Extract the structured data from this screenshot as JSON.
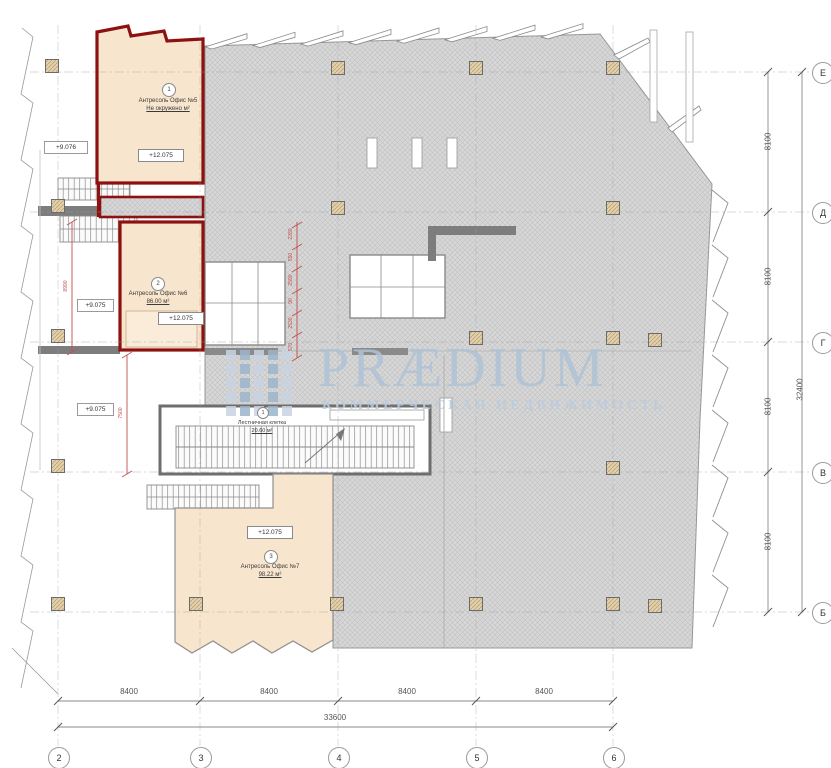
{
  "watermark": {
    "brand": "PRÆDIUM",
    "tagline": "КОММЕРЧЕСКАЯ НЕДВИЖИМОСТЬ"
  },
  "rooms": [
    {
      "num": "1",
      "name": "Антресоль Офис №5",
      "area": "Не окружено м²",
      "level": "+12.075"
    },
    {
      "num": "2",
      "name": "Антресоль Офис №6",
      "area": "86.00 м²",
      "level": "+12.075"
    },
    {
      "num": "3",
      "name": "Антресоль Офис №7",
      "area": "98.22 м²",
      "level": "+12.075"
    }
  ],
  "stairwell": {
    "num": "1",
    "name": "Лестничная клетка",
    "area": "20.60 м²"
  },
  "elevation_marks": {
    "left_upper": "+9.076",
    "left_middle": "+9.075",
    "left_lower": "+9.075"
  },
  "axes": {
    "bottom": [
      "2",
      "3",
      "4",
      "5",
      "6"
    ],
    "right": [
      "Е",
      "Д",
      "Г",
      "В",
      "Б"
    ]
  },
  "dimensions": {
    "bottom_segments": [
      "8400",
      "8400",
      "8400",
      "8400"
    ],
    "bottom_total": "33600",
    "right_segments": [
      "8100",
      "8100",
      "8100",
      "8100"
    ],
    "right_total": "32400",
    "red_chain": [
      "2280",
      "550",
      "2590",
      "90",
      "2530",
      "570"
    ],
    "red_left_height": "8990",
    "red_mid_height": "7500"
  },
  "colors": {
    "room_fill": "#f8e5cd",
    "room_outline": "#8e1111",
    "slab_gray": "#d7d7d7",
    "watermark_blue": "#aec2d6",
    "dim_red": "#c0504d"
  }
}
